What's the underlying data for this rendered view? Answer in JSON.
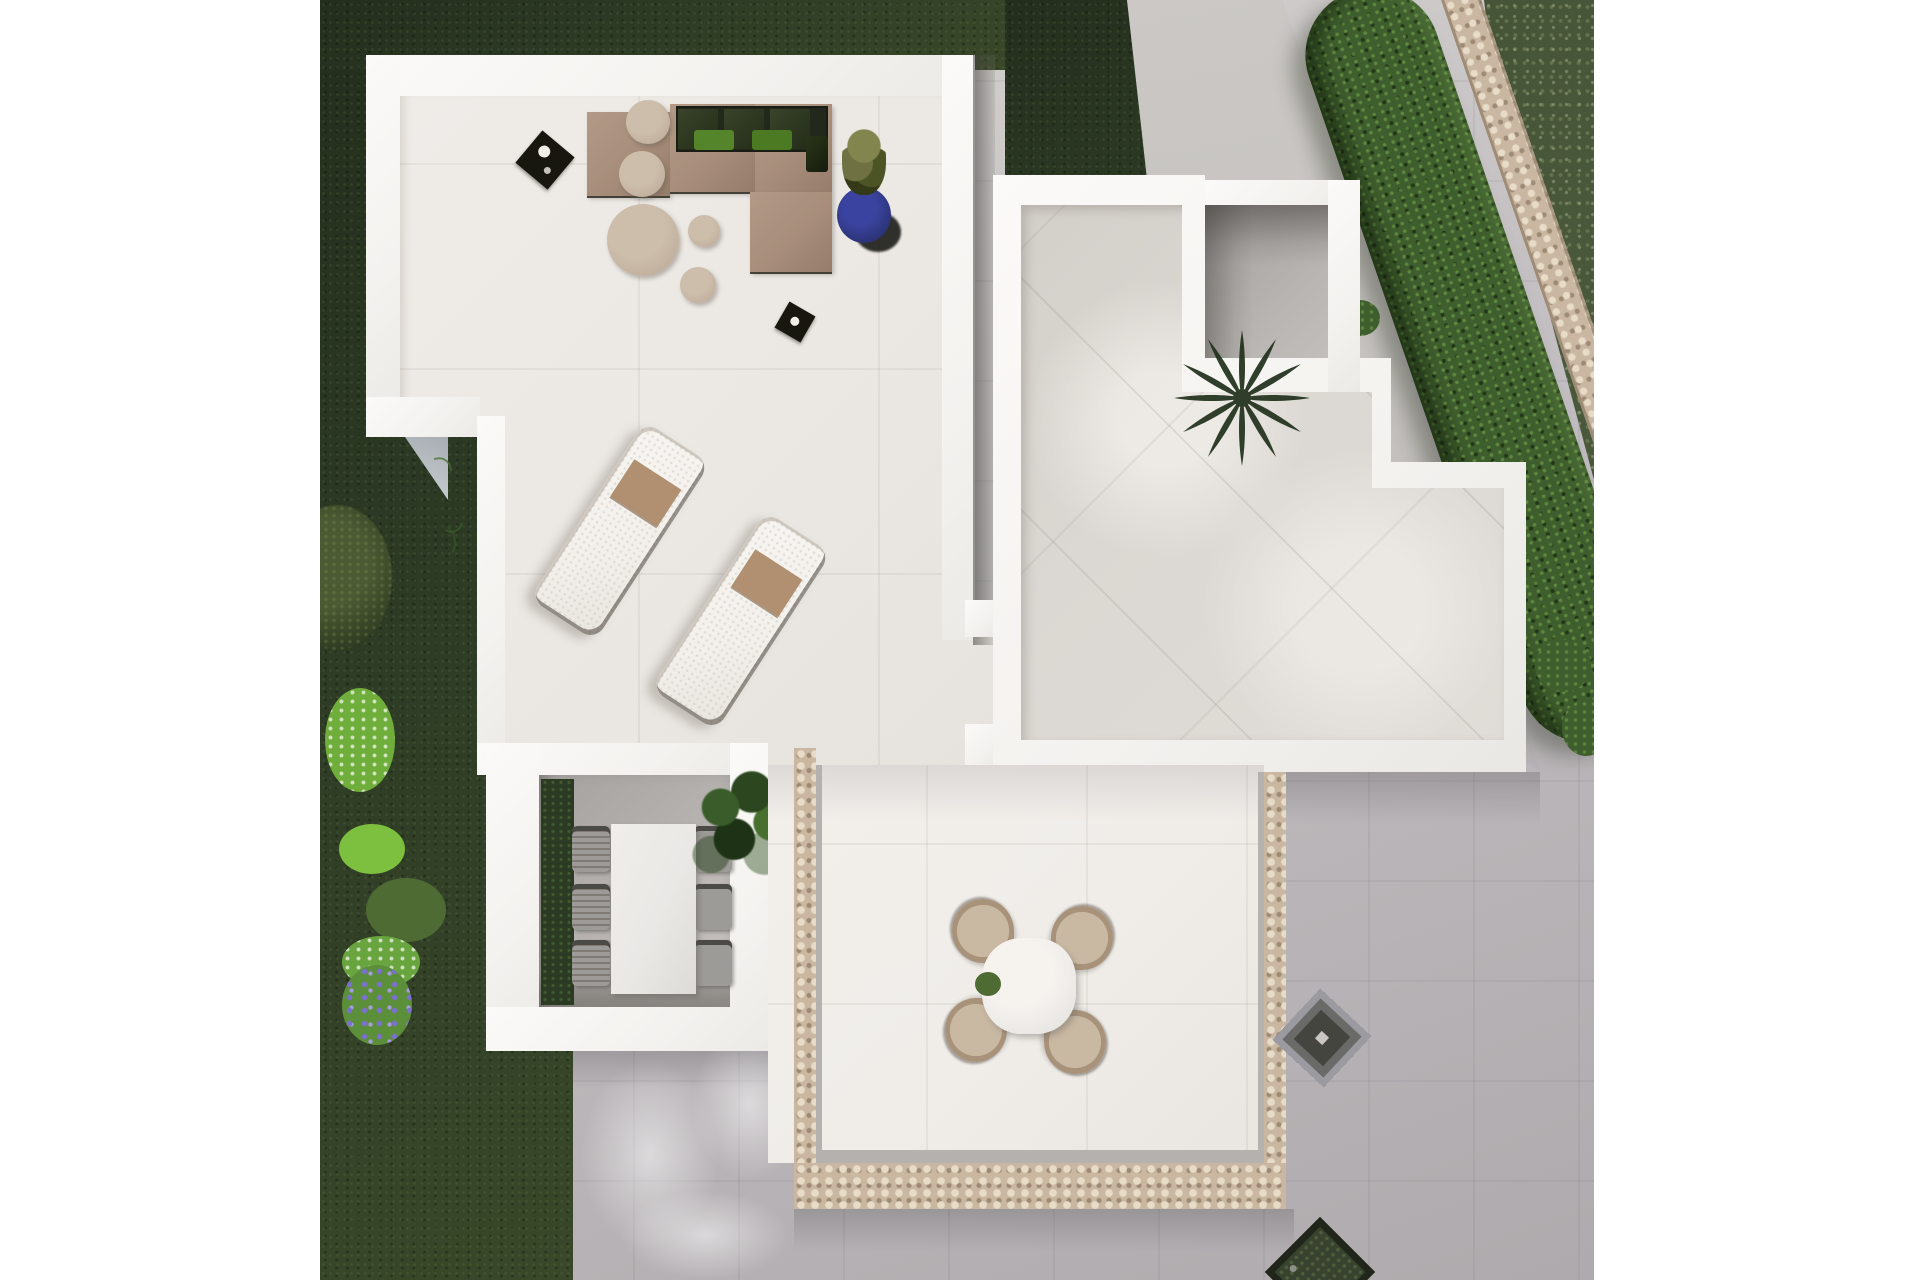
{
  "meta": {
    "description": "Top-down 3D architectural render of a villa roof terrace with garden, no visible text",
    "canvas": {
      "width": 1920,
      "height": 1280
    }
  },
  "palette": {
    "page-bg": "#ffffff",
    "wall": "#f4f2ef",
    "plaza": "#c2bec1",
    "plaza-warm": "#d8d5d2",
    "plaza-cool": "#aeaaad",
    "grass-dark": "#2d3b25",
    "grass-dark2": "#232e1c",
    "grass-light": "#394829",
    "grass-bright": "#49583b",
    "hedge": "#3f5e2e",
    "stone": "#c9b7a1",
    "stone-hi": "#e8dcc8",
    "stone-sh": "#9c8a74",
    "st-floor": "#ebe7e3",
    "rt-floor": "#dbd7d2",
    "bt-floor": "#f0ede9",
    "cy-floor": "#b3afac",
    "cy-floor2": "#c8c4c1",
    "cy-hedge": "#2b3a23",
    "taupe": "#a78d7a",
    "pouf": "#c2b19f",
    "pillow-green-1": "#55852a",
    "pillow-green-2": "#4b7a22",
    "pot-blue": "#2a3170",
    "lounger": "#f3f0ec",
    "towel": "#b09070",
    "chair-gray": "#9d9b98",
    "chair-dark": "#4c4a46",
    "table-white": "#eae8e5",
    "shell-seat": "#c9b9a3",
    "shell-rim": "#a8937a",
    "palm": "#20301b",
    "planter": "#39412f"
  },
  "scene": {
    "areas": [
      {
        "name": "sofa-roof-terrace",
        "position": "upper-left",
        "surface": "large light tiles"
      },
      {
        "name": "stepped-roof-terrace",
        "position": "right",
        "surface": "diagonal tiles"
      },
      {
        "name": "sunken-dining-courtyard",
        "position": "lower-left",
        "surface": "gray concrete"
      },
      {
        "name": "stone-edged-patio",
        "position": "bottom-center",
        "surface": "light tiles with pebble border"
      },
      {
        "name": "palm-courtyard",
        "position": "upper-right",
        "surface": "gray concrete"
      },
      {
        "name": "garden",
        "position": "left and top-right",
        "surface": "dark lawn with shrubs"
      }
    ],
    "furniture": [
      {
        "name": "l-shaped-outdoor-sofa",
        "count": 1,
        "pillows_green": 2,
        "cushions_dark": 3
      },
      {
        "name": "round-ottoman",
        "count": 1
      },
      {
        "name": "pouf",
        "count": 4
      },
      {
        "name": "candle-lantern",
        "count": 2
      },
      {
        "name": "plant-in-blue-pot",
        "count": 1
      },
      {
        "name": "sun-lounger-with-towel",
        "count": 2
      },
      {
        "name": "dining-table-rectangular",
        "count": 1,
        "chairs": 6
      },
      {
        "name": "round-table",
        "count": 1,
        "shell-chairs": 4
      },
      {
        "name": "potted-leaf-plant",
        "count": 1
      },
      {
        "name": "palm-tree",
        "count": 1
      },
      {
        "name": "roof-grate",
        "count": 1
      },
      {
        "name": "square-planter",
        "count": 1
      }
    ],
    "vegetation": [
      {
        "name": "diagonal-hedge-with-stone-path",
        "position": "top-right"
      },
      {
        "name": "flowering-bushes",
        "colors": [
          "white",
          "purple"
        ],
        "position": "left"
      },
      {
        "name": "tree-canopy",
        "position": "mid-left"
      }
    ]
  }
}
